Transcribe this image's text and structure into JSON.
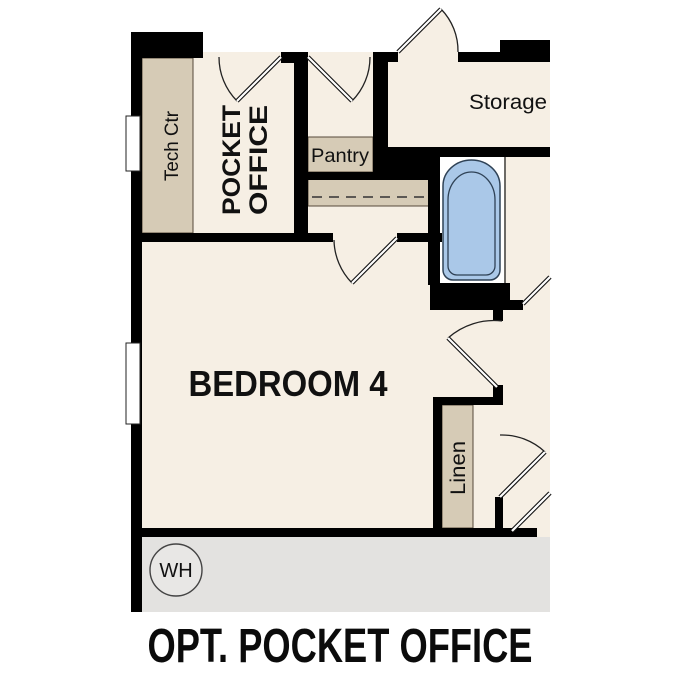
{
  "title": "OPT. POCKET OFFICE",
  "rooms": {
    "tech_ctr": {
      "label": "Tech Ctr"
    },
    "pocket_office": {
      "line1": "POCKET",
      "line2": "OFFICE"
    },
    "pantry": {
      "label": "Pantry"
    },
    "storage": {
      "label": "Storage"
    },
    "bedroom4": {
      "label": "BEDROOM 4"
    },
    "linen": {
      "label": "Linen"
    },
    "water_heater": {
      "label": "WH"
    }
  },
  "colors": {
    "wall": "#000000",
    "floor": "#f6efe4",
    "casework": "#d6cbb6",
    "tub": "#aac8e8",
    "tub_outline": "#2f4256",
    "garage": "#e3e2e0",
    "wh_circle": "#e8e7e5"
  }
}
